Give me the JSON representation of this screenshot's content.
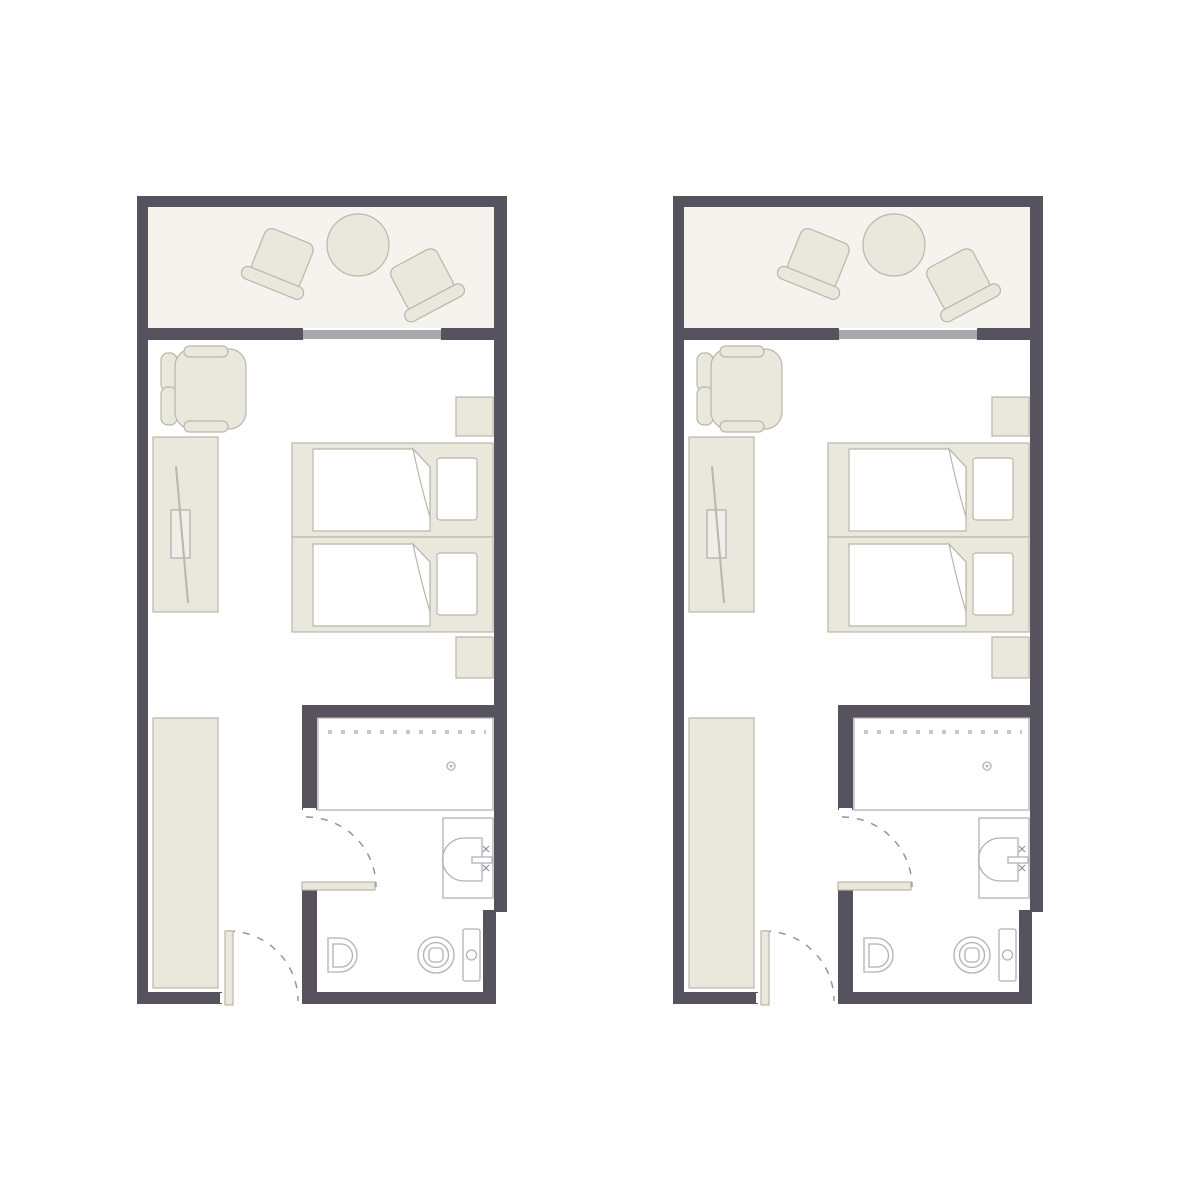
{
  "page": {
    "title": "Hotel guest room floor plans",
    "description": "Two identical twin-bed guest room units shown side by side, each with balcony, bedroom and bathroom",
    "units_count": 2,
    "background": "#ffffff"
  },
  "colors": {
    "bg": "#ffffff",
    "wall": "#56535e",
    "floor": "#f4f3ee",
    "furn": "#eae7dc",
    "furnStroke": "#b9b6ab",
    "fix": "#ffffff",
    "fixStroke": "#b2b0b6",
    "slide": "#a8a8ad",
    "dash": "#908e98",
    "dots": "#c9c7cc",
    "tvfill": "#f0eee6"
  },
  "units": [
    {
      "id": "room-unit-1",
      "label": "guest room unit 1"
    },
    {
      "id": "room-unit-2",
      "label": "guest room unit 2"
    }
  ],
  "unit_elements": [
    "balcony",
    "balcony-round-table",
    "balcony-chair-left",
    "balcony-chair-right",
    "sliding-glass-door",
    "armchair",
    "desk-console",
    "television",
    "twin-bed-1",
    "twin-bed-2",
    "pillow",
    "duvet-fold",
    "nightstand-top",
    "nightstand-bottom",
    "wardrobe",
    "bathroom",
    "bathtub",
    "bathtub-drain",
    "sink-vanity",
    "sink-basin",
    "faucet",
    "toilet",
    "toilet-tank",
    "bidet",
    "bathroom-door",
    "entry-door",
    "door-swing-arc"
  ]
}
